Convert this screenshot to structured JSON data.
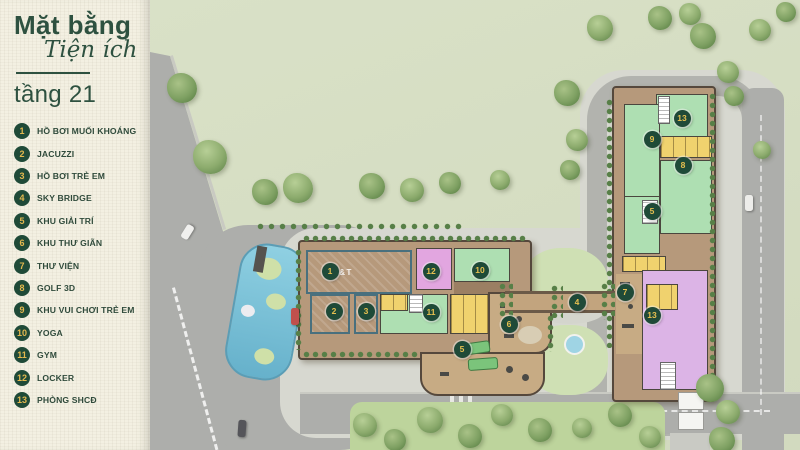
{
  "header": {
    "title_line1": "Mặt bằng",
    "title_line2": "Tiện ích",
    "floor": "tầng 21"
  },
  "legend": [
    {
      "num": "1",
      "label": "HỒ BƠI MUỐI KHOÁNG"
    },
    {
      "num": "2",
      "label": "JACUZZI"
    },
    {
      "num": "3",
      "label": "HỒ BƠI TRẺ EM"
    },
    {
      "num": "4",
      "label": "SKY BRIDGE"
    },
    {
      "num": "5",
      "label": "KHU GIẢI TRÍ"
    },
    {
      "num": "6",
      "label": "KHU THƯ GIÃN"
    },
    {
      "num": "7",
      "label": "THƯ VIỆN"
    },
    {
      "num": "8",
      "label": "GOLF 3D"
    },
    {
      "num": "9",
      "label": "KHU VUI CHƠI TRẺ EM"
    },
    {
      "num": "10",
      "label": "YOGA"
    },
    {
      "num": "11",
      "label": "GYM"
    },
    {
      "num": "12",
      "label": "LOCKER"
    },
    {
      "num": "13",
      "label": "PHÒNG SHCĐ"
    }
  ],
  "map": {
    "pool_watermark": "A&T",
    "markers": [
      {
        "num": "1",
        "x": 180,
        "y": 271
      },
      {
        "num": "2",
        "x": 184,
        "y": 311
      },
      {
        "num": "3",
        "x": 216,
        "y": 311
      },
      {
        "num": "12",
        "x": 281,
        "y": 271
      },
      {
        "num": "10",
        "x": 330,
        "y": 270
      },
      {
        "num": "11",
        "x": 281,
        "y": 312
      },
      {
        "num": "6",
        "x": 359,
        "y": 324
      },
      {
        "num": "5",
        "x": 312,
        "y": 349
      },
      {
        "num": "4",
        "x": 427,
        "y": 302
      },
      {
        "num": "7",
        "x": 475,
        "y": 292
      },
      {
        "num": "13",
        "x": 502,
        "y": 315
      },
      {
        "num": "9",
        "x": 502,
        "y": 139
      },
      {
        "num": "13",
        "x": 532,
        "y": 118
      },
      {
        "num": "8",
        "x": 533,
        "y": 165
      },
      {
        "num": "5",
        "x": 502,
        "y": 211
      }
    ],
    "trees": [
      [
        32,
        88,
        30
      ],
      [
        60,
        157,
        34
      ],
      [
        115,
        192,
        26
      ],
      [
        148,
        188,
        30
      ],
      [
        222,
        186,
        26
      ],
      [
        262,
        190,
        24
      ],
      [
        300,
        183,
        22
      ],
      [
        350,
        180,
        20
      ],
      [
        417,
        93,
        26
      ],
      [
        427,
        140,
        22
      ],
      [
        420,
        170,
        20
      ],
      [
        450,
        28,
        26
      ],
      [
        510,
        18,
        24
      ],
      [
        540,
        14,
        22
      ],
      [
        553,
        36,
        26
      ],
      [
        578,
        72,
        22
      ],
      [
        584,
        96,
        20
      ],
      [
        612,
        150,
        18
      ],
      [
        636,
        12,
        20
      ],
      [
        610,
        30,
        22
      ],
      [
        560,
        388,
        28
      ],
      [
        578,
        412,
        24
      ],
      [
        572,
        440,
        26
      ],
      [
        215,
        425,
        24
      ],
      [
        245,
        440,
        22
      ],
      [
        280,
        420,
        26
      ],
      [
        320,
        436,
        24
      ],
      [
        352,
        415,
        22
      ],
      [
        390,
        430,
        24
      ],
      [
        432,
        428,
        20
      ],
      [
        470,
        415,
        24
      ],
      [
        500,
        437,
        22
      ]
    ],
    "cars": [
      {
        "x": 30,
        "y": 228,
        "w": 15,
        "h": 8,
        "rot": -58,
        "color": "#f0f0ee"
      },
      {
        "x": 88,
        "y": 420,
        "w": 8,
        "h": 17,
        "rot": 4,
        "color": "#55555a"
      },
      {
        "x": 141,
        "y": 308,
        "w": 8,
        "h": 17,
        "rot": 0,
        "color": "#c0504d"
      },
      {
        "x": 595,
        "y": 195,
        "w": 8,
        "h": 16,
        "rot": 0,
        "color": "#ededea"
      }
    ]
  },
  "colors": {
    "sidebar_bg": "#f3f0e2",
    "accent_green": "#2e5140",
    "badge_bg": "#1f4a38",
    "badge_gold": "#e3b84e",
    "room_green": "#aedfb2",
    "room_yellow": "#f0d26e",
    "room_pink": "#e2a6e0",
    "room_lavender": "#dcb4e6",
    "pool_blue": "#7fc3d8",
    "grass": "#d6dec4",
    "road": "#adaeab",
    "building_tan": "#b6997b"
  }
}
